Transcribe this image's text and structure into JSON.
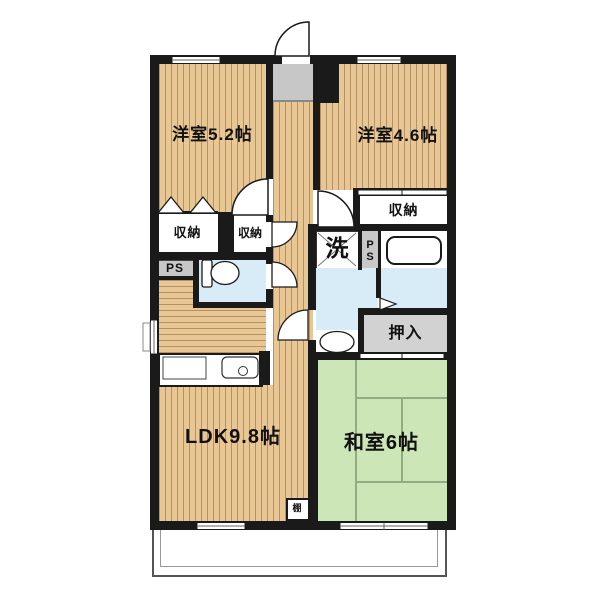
{
  "floorplan": {
    "type": "japanese-apartment-3ldk",
    "rooms": {
      "bedroom1": {
        "label": "洋室5.2帖"
      },
      "bedroom2": {
        "label": "洋室4.6帖"
      },
      "ldk": {
        "label": "LDK9.8帖"
      },
      "washitsu": {
        "label": "和室6帖"
      },
      "closet1": {
        "label": "収納"
      },
      "closet2": {
        "label": "収納"
      },
      "closet3": {
        "label": "収納"
      },
      "ps1": {
        "label": "PS"
      },
      "ps2": {
        "label": "PS"
      },
      "laundry": {
        "label": "洗"
      },
      "oshiire": {
        "label": "押入"
      },
      "shelf": {
        "label": "棚"
      }
    },
    "fixtures": [
      "toilet-icon",
      "bathtub-icon",
      "washbasin-icon",
      "kitchen-sink-icon",
      "entrance-door-icon",
      "washing-machine-pan-icon"
    ],
    "colors": {
      "wood_floor": "#e9c795",
      "tatami": "#cde6b8",
      "wet_area": "#d7ecf6",
      "gray_area": "#c7c7c7",
      "wall": "#1a1a1a"
    }
  }
}
